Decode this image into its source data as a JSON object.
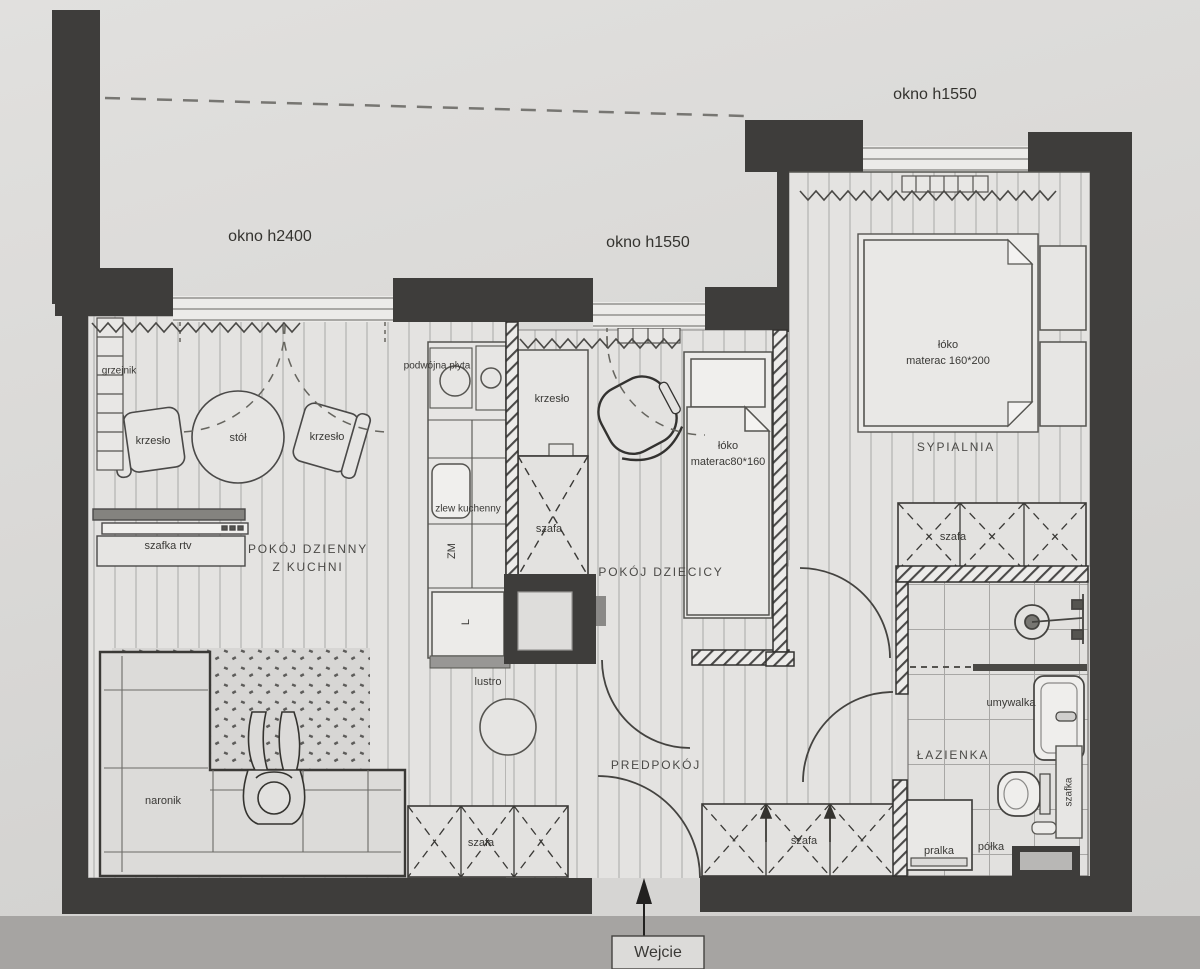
{
  "document": {
    "type": "apartment floor plan",
    "language": "Polish"
  },
  "colors": {
    "wall": "#3e3d3b",
    "paper_floor": "#e4e3e1",
    "background": "#d8d7d5",
    "bottom_shadow": "#a6a4a2",
    "hatch_line": "#4a4948"
  },
  "labels": {
    "okno_top": "okno h1550",
    "okno_living": "okno h2400",
    "okno_children": "okno h1550",
    "grzejnik": "grzejnik",
    "krzeslo_living_left": "krzesło",
    "stol": "stół",
    "krzeslo_living_right": "krzesło",
    "szafka_rtv": "szafka rtv",
    "living_room_line1": "POKÓJ DZIENNY",
    "living_room_line2": "Z KUCHNI",
    "podwojna_plyta": "podwójna płyta",
    "zlew_kuchenny": "zlew kuchenny",
    "zmywarka": "ZM",
    "lodowka": "L",
    "krzeslo_children": "krzesło",
    "szafa_corridor": "szafa",
    "bed_children_line1": "łóko",
    "bed_children_line2": "materac80*160",
    "children_room": "POKÓJ DZIECICY",
    "bed_bedroom_line1": "łóko",
    "bed_bedroom_line2": "materac 160*200",
    "bedroom": "SYPIALNIA",
    "szafa_bedroom": "szafa",
    "umywalka": "umywalka",
    "bathroom": "ŁAZIENKA",
    "szafka_bathroom": "szafka",
    "pralka": "pralka",
    "polka": "półka",
    "naronik": "naronik",
    "lustro": "lustro",
    "hallway": "PREDPOKÓJ",
    "szafa_hall_left": "szafa",
    "szafa_hall_right": "szafa",
    "entrance": "Wejcie"
  }
}
